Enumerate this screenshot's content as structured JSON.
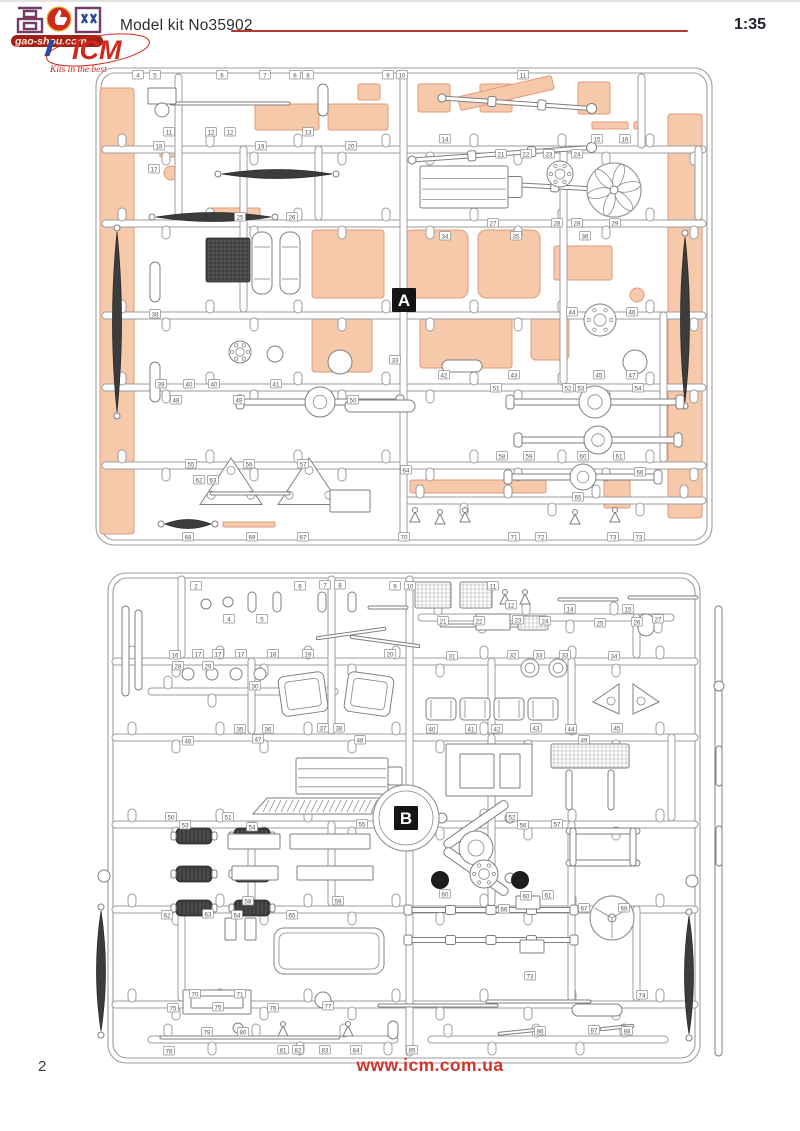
{
  "header": {
    "title": "Model kit No35902",
    "scale": "1:35"
  },
  "footer": {
    "page_number": "2",
    "url": "www.icm.com.ua"
  },
  "watermark": {
    "site_char_left": "高",
    "site_char_right": "网",
    "thumb_icon": "thumbs-up-icon",
    "site_domain": "gao-shou.com",
    "brand": "ICM",
    "slogan": "Kits in the best"
  },
  "colors": {
    "accent_red": "#b5372e",
    "link_red": "#cf352c",
    "highlight_fill": "#f7c9ab",
    "highlight_stroke": "#e2997a",
    "sprue_line": "#9d9d9d",
    "label_bg": "#151515"
  },
  "sprues": {
    "a": {
      "letter": "A",
      "tags": [
        [
          4,
          48,
          13
        ],
        [
          5,
          65,
          13
        ],
        [
          6,
          132,
          13
        ],
        [
          7,
          175,
          13
        ],
        [
          8,
          205,
          13
        ],
        [
          8,
          218,
          13
        ],
        [
          9,
          298,
          13
        ],
        [
          10,
          312,
          13
        ],
        [
          11,
          433,
          13
        ],
        [
          11,
          79,
          70
        ],
        [
          12,
          121,
          70
        ],
        [
          12,
          140,
          70
        ],
        [
          13,
          218,
          70
        ],
        [
          14,
          355,
          77
        ],
        [
          15,
          507,
          77
        ],
        [
          16,
          535,
          77
        ],
        [
          17,
          64,
          107
        ],
        [
          18,
          69,
          84
        ],
        [
          19,
          171,
          84
        ],
        [
          20,
          261,
          84
        ],
        [
          21,
          411,
          92
        ],
        [
          22,
          436,
          92
        ],
        [
          23,
          459,
          92
        ],
        [
          24,
          487,
          92
        ],
        [
          25,
          150,
          155
        ],
        [
          26,
          202,
          155
        ],
        [
          27,
          403,
          161
        ],
        [
          28,
          467,
          161
        ],
        [
          28,
          487,
          161
        ],
        [
          29,
          525,
          161
        ],
        [
          33,
          305,
          298
        ],
        [
          34,
          355,
          174
        ],
        [
          35,
          426,
          174
        ],
        [
          36,
          495,
          174
        ],
        [
          38,
          65,
          252
        ],
        [
          39,
          71,
          322
        ],
        [
          40,
          99,
          322
        ],
        [
          40,
          124,
          322
        ],
        [
          41,
          186,
          322
        ],
        [
          42,
          354,
          313
        ],
        [
          43,
          424,
          313
        ],
        [
          44,
          482,
          250
        ],
        [
          45,
          509,
          313
        ],
        [
          46,
          542,
          250
        ],
        [
          47,
          542,
          313
        ],
        [
          48,
          86,
          338
        ],
        [
          49,
          149,
          338
        ],
        [
          50,
          263,
          338
        ],
        [
          51,
          406,
          326
        ],
        [
          52,
          478,
          326
        ],
        [
          53,
          491,
          326
        ],
        [
          54,
          548,
          326
        ],
        [
          55,
          101,
          402
        ],
        [
          56,
          159,
          402
        ],
        [
          57,
          213,
          402
        ],
        [
          58,
          412,
          394
        ],
        [
          59,
          439,
          394
        ],
        [
          60,
          493,
          394
        ],
        [
          61,
          529,
          394
        ],
        [
          62,
          109,
          418
        ],
        [
          63,
          123,
          418
        ],
        [
          64,
          316,
          408
        ],
        [
          65,
          488,
          435
        ],
        [
          66,
          550,
          410
        ],
        [
          67,
          213,
          475
        ],
        [
          68,
          98,
          475
        ],
        [
          69,
          162,
          475
        ],
        [
          70,
          314,
          475
        ],
        [
          71,
          424,
          475
        ],
        [
          72,
          451,
          475
        ],
        [
          73,
          523,
          475
        ],
        [
          73,
          549,
          475
        ]
      ]
    },
    "b": {
      "letter": "B",
      "tags": [
        [
          2,
          108,
          20
        ],
        [
          4,
          141,
          53
        ],
        [
          5,
          174,
          53
        ],
        [
          6,
          212,
          20
        ],
        [
          7,
          237,
          19
        ],
        [
          8,
          252,
          19
        ],
        [
          9,
          307,
          20
        ],
        [
          10,
          322,
          20
        ],
        [
          11,
          405,
          20
        ],
        [
          12,
          423,
          39
        ],
        [
          14,
          482,
          43
        ],
        [
          15,
          540,
          43
        ],
        [
          16,
          87,
          89
        ],
        [
          17,
          110,
          88
        ],
        [
          17,
          130,
          88
        ],
        [
          17,
          153,
          88
        ],
        [
          18,
          185,
          88
        ],
        [
          19,
          220,
          88
        ],
        [
          20,
          302,
          88
        ],
        [
          21,
          355,
          55
        ],
        [
          22,
          391,
          55
        ],
        [
          23,
          430,
          54
        ],
        [
          24,
          457,
          55
        ],
        [
          25,
          512,
          57
        ],
        [
          26,
          549,
          56
        ],
        [
          27,
          570,
          53
        ],
        [
          28,
          90,
          100
        ],
        [
          29,
          120,
          100
        ],
        [
          30,
          167,
          120
        ],
        [
          31,
          364,
          90
        ],
        [
          32,
          425,
          89
        ],
        [
          33,
          451,
          89
        ],
        [
          33,
          477,
          89
        ],
        [
          34,
          526,
          90
        ],
        [
          35,
          152,
          163
        ],
        [
          36,
          180,
          163
        ],
        [
          37,
          235,
          162
        ],
        [
          38,
          251,
          162
        ],
        [
          40,
          344,
          163
        ],
        [
          41,
          383,
          163
        ],
        [
          42,
          409,
          163
        ],
        [
          43,
          448,
          162
        ],
        [
          44,
          483,
          163
        ],
        [
          45,
          529,
          162
        ],
        [
          46,
          100,
          175
        ],
        [
          47,
          170,
          173
        ],
        [
          48,
          272,
          174
        ],
        [
          49,
          496,
          174
        ],
        [
          50,
          83,
          251
        ],
        [
          51,
          140,
          251
        ],
        [
          52,
          424,
          251
        ],
        [
          53,
          97,
          259
        ],
        [
          54,
          164,
          261
        ],
        [
          55,
          274,
          258
        ],
        [
          56,
          435,
          259
        ],
        [
          57,
          469,
          258
        ],
        [
          58,
          160,
          335
        ],
        [
          59,
          250,
          335
        ],
        [
          60,
          357,
          328
        ],
        [
          60,
          438,
          330
        ],
        [
          61,
          460,
          329
        ],
        [
          62,
          79,
          349
        ],
        [
          63,
          120,
          348
        ],
        [
          64,
          149,
          349
        ],
        [
          65,
          204,
          349
        ],
        [
          66,
          416,
          343
        ],
        [
          67,
          496,
          342
        ],
        [
          68,
          536,
          342
        ],
        [
          70,
          107,
          428
        ],
        [
          71,
          152,
          428
        ],
        [
          73,
          442,
          410
        ],
        [
          74,
          554,
          429
        ],
        [
          75,
          85,
          442
        ],
        [
          75,
          130,
          441
        ],
        [
          76,
          185,
          442
        ],
        [
          77,
          240,
          440
        ],
        [
          78,
          81,
          485
        ],
        [
          79,
          119,
          466
        ],
        [
          80,
          155,
          466
        ],
        [
          81,
          195,
          484
        ],
        [
          82,
          210,
          484
        ],
        [
          83,
          237,
          484
        ],
        [
          84,
          268,
          484
        ],
        [
          85,
          324,
          484
        ],
        [
          86,
          452,
          465
        ],
        [
          87,
          506,
          464
        ],
        [
          88,
          539,
          465
        ]
      ]
    }
  }
}
